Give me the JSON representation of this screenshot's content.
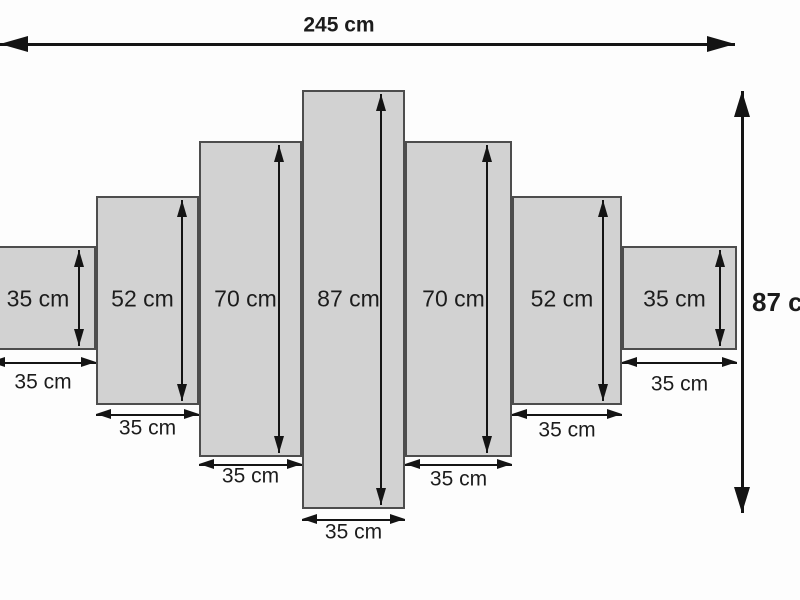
{
  "colors": {
    "background": "#fdfdfd",
    "panel_fill": "#d2d2d2",
    "panel_border": "#4d4d4d",
    "line": "#141414",
    "text": "#1c1c1c"
  },
  "overall_width": {
    "label": "245 cm",
    "value_cm": 245
  },
  "overall_height": {
    "label": "87 cm",
    "value_cm": 87
  },
  "unit": "cm",
  "panels": [
    {
      "height_cm": 35,
      "width_cm": 35,
      "height_label": "35 cm",
      "width_label": "35 cm",
      "px": {
        "left": -10,
        "top": 246,
        "width": 106,
        "height": 104,
        "varrow_x": 79,
        "warrow_y": 363,
        "wlabel_y": 382
      }
    },
    {
      "height_cm": 52,
      "width_cm": 35,
      "height_label": "52 cm",
      "width_label": "35 cm",
      "px": {
        "left": 96,
        "top": 196,
        "width": 103,
        "height": 209,
        "varrow_x": 182,
        "warrow_y": 415,
        "wlabel_y": 428
      }
    },
    {
      "height_cm": 70,
      "width_cm": 35,
      "height_label": "70 cm",
      "width_label": "35 cm",
      "px": {
        "left": 199,
        "top": 141,
        "width": 103,
        "height": 316,
        "varrow_x": 279,
        "warrow_y": 465,
        "wlabel_y": 476
      }
    },
    {
      "height_cm": 87,
      "width_cm": 35,
      "height_label": "87 cm",
      "width_label": "35 cm",
      "px": {
        "left": 302,
        "top": 90,
        "width": 103,
        "height": 419,
        "varrow_x": 381,
        "warrow_y": 520,
        "wlabel_y": 532
      }
    },
    {
      "height_cm": 70,
      "width_cm": 35,
      "height_label": "70 cm",
      "width_label": "35 cm",
      "px": {
        "left": 405,
        "top": 141,
        "width": 107,
        "height": 316,
        "varrow_x": 487,
        "warrow_y": 465,
        "wlabel_y": 479
      }
    },
    {
      "height_cm": 52,
      "width_cm": 35,
      "height_label": "52 cm",
      "width_label": "35 cm",
      "px": {
        "left": 512,
        "top": 196,
        "width": 110,
        "height": 209,
        "varrow_x": 603,
        "warrow_y": 415,
        "wlabel_y": 430
      }
    },
    {
      "height_cm": 35,
      "width_cm": 35,
      "height_label": "35 cm",
      "width_label": "35 cm",
      "px": {
        "left": 622,
        "top": 246,
        "width": 115,
        "height": 104,
        "varrow_x": 720,
        "warrow_y": 363,
        "wlabel_y": 384
      }
    }
  ],
  "dimension_arrows": {
    "top": {
      "x1": 0,
      "x2": 735,
      "y": 44,
      "label_x": 339,
      "label_y": 25
    },
    "right": {
      "x": 741,
      "y1": 91,
      "y2": 513,
      "label_x": 752,
      "label_y": 302
    }
  }
}
